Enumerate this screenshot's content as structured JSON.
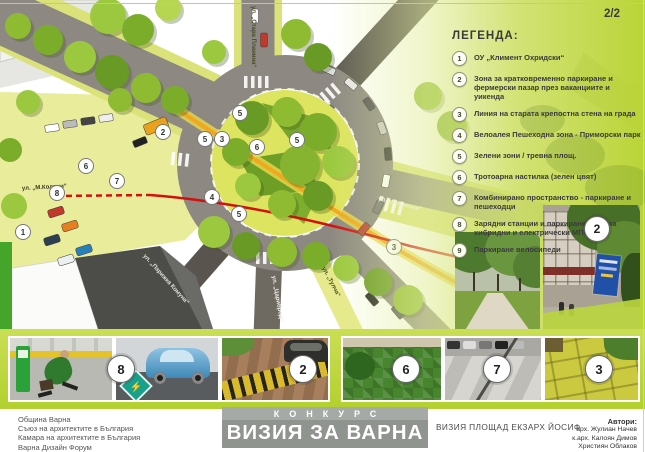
{
  "page": {
    "page_number": "2/2"
  },
  "legend": {
    "title": "ЛЕГЕНДА:",
    "items": [
      {
        "num": "1",
        "text": "ОУ „Климент Охридски“"
      },
      {
        "num": "2",
        "text": "Зона за кратковременно паркиране и фермерски пазар през ваканциите и уикенда"
      },
      {
        "num": "3",
        "text": "Линия на старата крепостна стена на града"
      },
      {
        "num": "4",
        "text": "Велоалея Пешеходна зона - Приморски парк"
      },
      {
        "num": "5",
        "text": "Зелени зони / тревна площ."
      },
      {
        "num": "6",
        "text": "Тротоарна настилка (зелен цвят)"
      },
      {
        "num": "7",
        "text": "Комбинирано пространство - паркиране и пешеходци"
      },
      {
        "num": "8",
        "text": "Зарядни станции и паркиране само за хибридни и електрически МПС"
      },
      {
        "num": "9",
        "text": "Паркиране велосипеди"
      }
    ]
  },
  "map": {
    "street_labels": [
      "ул. „Стара Планина“",
      "ул. „М.Колони“",
      "ул. „М.Колони“",
      "ул. „Парижка Комуна“",
      "ул. „Цариброд“",
      "ул. „Тулча“"
    ],
    "markers": [
      "1",
      "2",
      "5",
      "3",
      "5",
      "5",
      "6",
      "4",
      "5",
      "6",
      "7",
      "8",
      "3"
    ]
  },
  "photos": {
    "badges": [
      "8",
      "2",
      "6",
      "7",
      "3"
    ],
    "tall_badge": "2"
  },
  "footer": {
    "organizers": [
      "Община Варна",
      "Съюз на архитектите в България",
      "Камара на архитектите в България",
      "Варна Дизайн Форум"
    ],
    "contest_label": "КОНКУРС",
    "contest_title": "ВИЗИЯ ЗА ВАРНА",
    "project_title": "ВИЗИЯ ПЛОЩАД ЕКЗАРХ ЙОСИФ",
    "authors_label": "Автори:",
    "authors": [
      "арх. Жулиан Начев",
      "к.арх. Калоян Димов",
      "Християн Облаков"
    ]
  },
  "colors": {
    "legend_green": "#cfe069",
    "band_green": "#b2d02f",
    "fortress_line_red": "#d40f0f",
    "velo_alley_orange": "#f2a71d",
    "road_gray": "#8d8982"
  }
}
